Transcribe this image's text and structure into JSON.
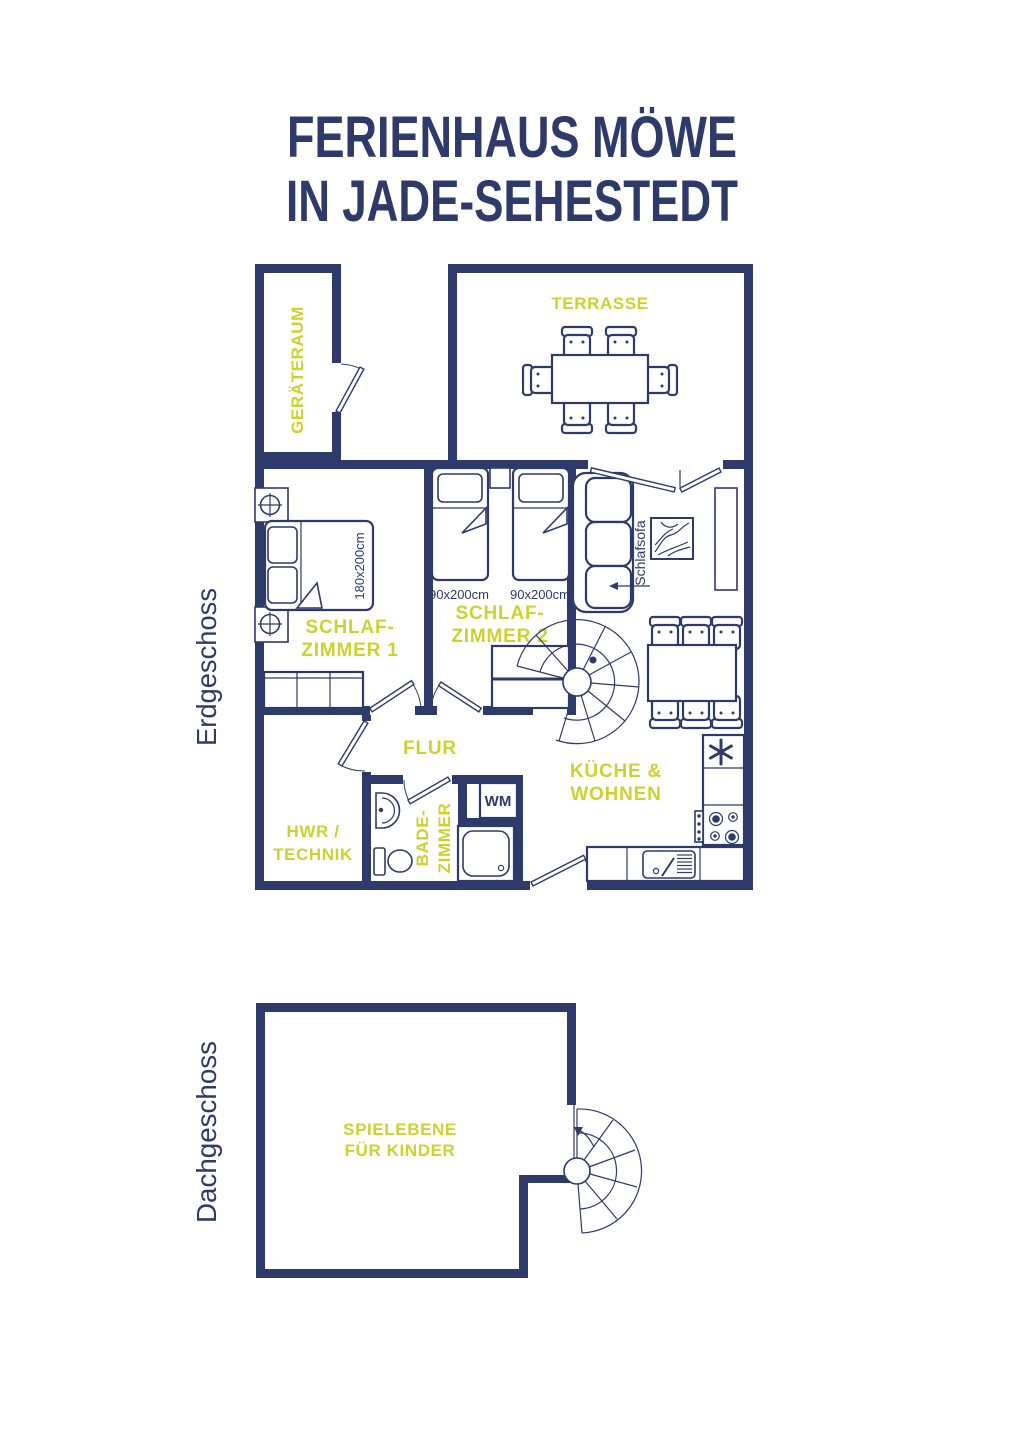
{
  "colors": {
    "navy": "#2e3a6a",
    "accent": "#cdd22f",
    "background": "#ffffff"
  },
  "title": {
    "line1": "FERIENHAUS MÖWE",
    "line2": "IN JADE-SEHESTEDT"
  },
  "floor_labels": {
    "ground": "Erdgeschoss",
    "attic": "Dachgeschoss"
  },
  "ground_floor": {
    "geraeteraum_label": "GERÄTERAUM",
    "terrasse_label": "TERRASSE",
    "schlafzimmer1": {
      "label_line1": "SCHLAF-",
      "label_line2": "ZIMMER 1",
      "bed_size": "180x200cm"
    },
    "schlafzimmer2": {
      "label_line1": "SCHLAF-",
      "label_line2": "ZIMMER 2",
      "bed_left_size": "90x200cm",
      "bed_right_size": "90x200cm"
    },
    "flur_label": "FLUR",
    "hwr": {
      "label_line1": "HWR /",
      "label_line2": "TECHNIK"
    },
    "bad": {
      "label_line1": "BADE-",
      "label_line2": "ZIMMER"
    },
    "kueche": {
      "label_line1": "KÜCHE &",
      "label_line2": "WOHNEN"
    },
    "sofa_annotation": "Schlafsofa",
    "washing_machine_label": "WM",
    "freezer_symbol": "*"
  },
  "attic_floor": {
    "spielebene": {
      "label_line1": "SPIELEBENE",
      "label_line2": "FÜR KINDER"
    }
  }
}
